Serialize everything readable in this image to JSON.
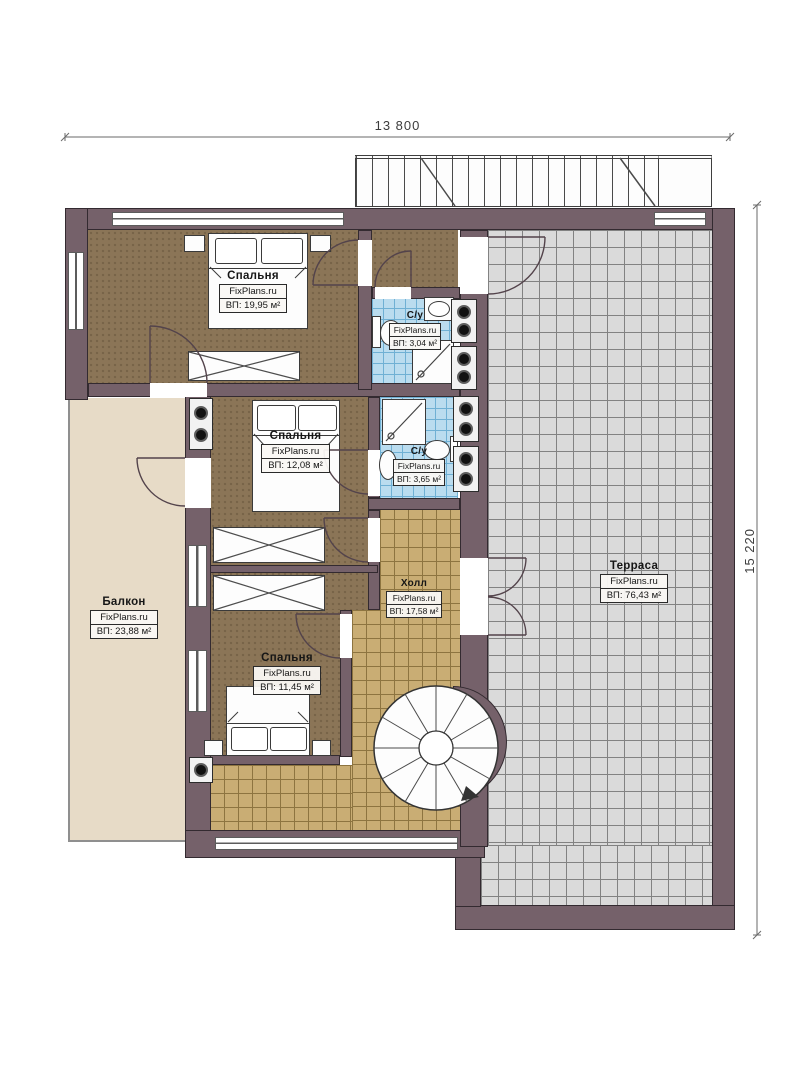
{
  "dimensions": {
    "top": "13 800",
    "right": "15 220"
  },
  "rooms": [
    {
      "id": "bedroom-1",
      "name": "Спальня",
      "site": "FixPlans.ru",
      "area": "ВП: 19,95 м²"
    },
    {
      "id": "bathroom-1",
      "name": "С/у",
      "site": "FixPlans.ru",
      "area": "ВП: 3,04 м²"
    },
    {
      "id": "bedroom-2",
      "name": "Спальня",
      "site": "FixPlans.ru",
      "area": "ВП: 12,08 м²"
    },
    {
      "id": "bathroom-2",
      "name": "С/у",
      "site": "FixPlans.ru",
      "area": "ВП: 3,65 м²"
    },
    {
      "id": "balcony",
      "name": "Балкон",
      "site": "FixPlans.ru",
      "area": "ВП: 23,88 м²"
    },
    {
      "id": "hall",
      "name": "Холл",
      "site": "FixPlans.ru",
      "area": "ВП: 17,58 м²"
    },
    {
      "id": "bedroom-3",
      "name": "Спальня",
      "site": "FixPlans.ru",
      "area": "ВП: 11,45 м²"
    },
    {
      "id": "terrace",
      "name": "Терраса",
      "site": "FixPlans.ru",
      "area": "ВП: 76,43 м²"
    }
  ],
  "colors": {
    "paper": "#ffffff",
    "wall": "#75616a",
    "wallEdge": "#332a30",
    "bedroomFloor": "#8b7557",
    "hallFloor": "#c9ad74",
    "hallGrid": "#8d7440",
    "bathFloor": "#badcef",
    "bathGrid": "#6fb0d4",
    "terraceFloor": "#dadada",
    "terraceGrid": "#828282",
    "balconyFloor": "#e7dbc7",
    "line": "#4a3c42"
  }
}
